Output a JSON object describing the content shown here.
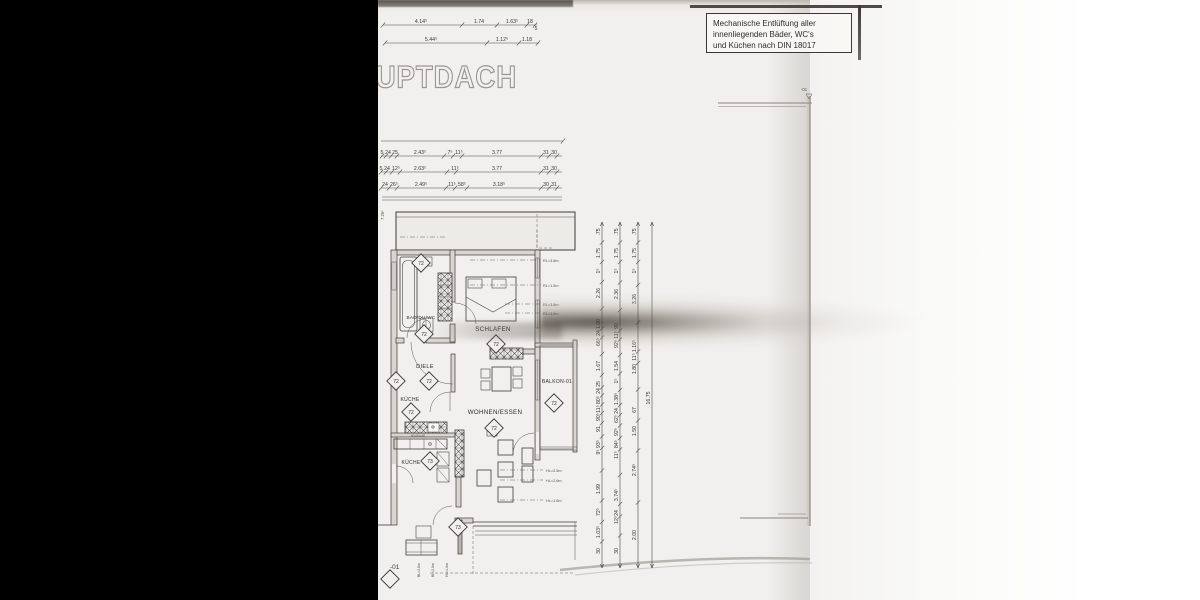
{
  "colors": {
    "paper": "#f1f0ee",
    "ink": "#3a3835",
    "black_bar": "#000000"
  },
  "title": {
    "text": "HAUPTDACH"
  },
  "note_box": {
    "line1": "Mechanische Entlüftung aller",
    "line2": "innenliegenden Bäder, WC's",
    "line3": "und Küchen nach DIN 18017"
  },
  "plan": {
    "rooms": {
      "bad": "BAD/DU/WC",
      "schlafen": "SCHLAFEN",
      "diele": "DIELE",
      "kueche1": "KÜCHE",
      "wohnen": "WOHNEN/ESSEN",
      "balkon": "BALKON-01",
      "kueche2": "KÜCHE"
    },
    "unit_primary": "72",
    "unit_secondary": "73",
    "level_label": "-01",
    "elevation_label": "-01",
    "left_edge_dim": "7.26⁵",
    "counter_dims": "60=60=60",
    "height_labels_upper": [
      "RL=3.8m",
      "RL=1.5m",
      "RL=3.8m",
      "RL=3.8m"
    ],
    "height_labels_lower": [
      "HL=2.5m",
      "HL=2.6m",
      "HL=1.6m"
    ],
    "height_labels_bottom": [
      "BL=2.8m",
      "BL=2.8m",
      "HL=1.6m"
    ]
  },
  "dims": {
    "horizontal_chains": [
      {
        "y": 25,
        "x1": 383,
        "x2": 537,
        "ticks": [
          383,
          462,
          497,
          527,
          535
        ],
        "labels": [
          {
            "t": "4.14⁵",
            "x": 421
          },
          {
            "t": "1.74",
            "x": 479
          },
          {
            "t": "1.63⁵",
            "x": 512
          },
          {
            "t": "18",
            "x": 530
          },
          {
            "t": "5",
            "x": 536,
            "dy": 7
          }
        ]
      },
      {
        "y": 43,
        "x1": 385,
        "x2": 539,
        "ticks": [
          385,
          487,
          519,
          538
        ],
        "labels": [
          {
            "t": "5.44⁵",
            "x": 431
          },
          {
            "t": "1.12⁵",
            "x": 502
          },
          {
            "t": "1.18",
            "x": 527
          }
        ]
      },
      {
        "y": 141,
        "x1": 381,
        "x2": 563,
        "ticks": [
          563
        ],
        "labels": []
      },
      {
        "y": 156,
        "x1": 381,
        "x2": 562,
        "ticks": [
          382,
          386,
          391,
          397,
          444,
          453,
          462,
          541,
          549,
          557
        ],
        "labels": [
          {
            "t": "5",
            "x": 382
          },
          {
            "t": "24",
            "x": 388
          },
          {
            "t": "25",
            "x": 395
          },
          {
            "t": "2.43⁵",
            "x": 420
          },
          {
            "t": "7⁵",
            "x": 450
          },
          {
            "t": "11⁵",
            "x": 459
          },
          {
            "t": "3.77",
            "x": 497
          },
          {
            "t": "31",
            "x": 546
          },
          {
            "t": "30",
            "x": 554
          }
        ]
      },
      {
        "y": 172,
        "x1": 381,
        "x2": 562,
        "ticks": [
          381,
          386,
          392,
          400,
          447,
          456,
          541,
          549,
          557
        ],
        "labels": [
          {
            "t": "5",
            "x": 381
          },
          {
            "t": "24",
            "x": 387
          },
          {
            "t": "12⁵",
            "x": 396
          },
          {
            "t": "2.63⁵",
            "x": 420
          },
          {
            "t": "11⁵",
            "x": 455
          },
          {
            "t": "3.77",
            "x": 497
          },
          {
            "t": "31",
            "x": 546
          },
          {
            "t": "30",
            "x": 554
          }
        ]
      },
      {
        "y": 188,
        "x1": 381,
        "x2": 562,
        "ticks": [
          381,
          389,
          397,
          446,
          455,
          467,
          541,
          549,
          557
        ],
        "labels": [
          {
            "t": "24",
            "x": 385
          },
          {
            "t": "26⁵",
            "x": 394
          },
          {
            "t": "2.49⁵",
            "x": 421
          },
          {
            "t": "11⁵",
            "x": 452
          },
          {
            "t": "58⁵",
            "x": 462
          },
          {
            "t": "3.18⁵",
            "x": 499
          },
          {
            "t": "30",
            "x": 546
          },
          {
            "t": "31",
            "x": 554
          }
        ]
      }
    ],
    "vertical_chains": [
      {
        "x": 602,
        "y1": 222,
        "y2": 568,
        "labels": [
          {
            "t": ".75",
            "y": 232
          },
          {
            "t": "1.75",
            "y": 253
          },
          {
            "t": "1⁵",
            "y": 271
          },
          {
            "t": "2.26",
            "y": 293
          },
          {
            "t": "1.00",
            "y": 324
          },
          {
            "t": "24",
            "y": 333
          },
          {
            "t": "66⁵",
            "y": 342
          },
          {
            "t": "1.67",
            "y": 366
          },
          {
            "t": "25",
            "y": 384
          },
          {
            "t": "24",
            "y": 391
          },
          {
            "t": "80⁵",
            "y": 400
          },
          {
            "t": "11⁵",
            "y": 409
          },
          {
            "t": "90⁵",
            "y": 417
          },
          {
            "t": "91",
            "y": 429
          },
          {
            "t": "93⁵",
            "y": 444
          },
          {
            "t": "9⁵",
            "y": 452
          },
          {
            "t": "1.99",
            "y": 489
          },
          {
            "t": "72⁵",
            "y": 512
          },
          {
            "t": "1.03⁵",
            "y": 532
          },
          {
            "t": "30",
            "y": 551
          }
        ]
      },
      {
        "x": 620,
        "y1": 222,
        "y2": 568,
        "labels": [
          {
            "t": ".75",
            "y": 232
          },
          {
            "t": "1.75",
            "y": 253
          },
          {
            "t": "1⁵",
            "y": 271
          },
          {
            "t": "2.36",
            "y": 294
          },
          {
            "t": "90",
            "y": 326
          },
          {
            "t": "11⁵",
            "y": 335
          },
          {
            "t": "92⁵",
            "y": 344
          },
          {
            "t": "1.54",
            "y": 366
          },
          {
            "t": "1⁵",
            "y": 381
          },
          {
            "t": "1.38⁵",
            "y": 399
          },
          {
            "t": "24",
            "y": 411
          },
          {
            "t": "62⁵",
            "y": 419
          },
          {
            "t": "92⁵",
            "y": 432
          },
          {
            "t": "84⁵",
            "y": 444
          },
          {
            "t": "11⁵",
            "y": 455
          },
          {
            "t": "3.74⁵",
            "y": 495
          },
          {
            "t": "24",
            "y": 513
          },
          {
            "t": "12⁵",
            "y": 520
          },
          {
            "t": "30",
            "y": 551
          }
        ]
      },
      {
        "x": 638,
        "y1": 222,
        "y2": 568,
        "labels": [
          {
            "t": ".75",
            "y": 232
          },
          {
            "t": "1.75",
            "y": 253
          },
          {
            "t": "1⁵",
            "y": 271
          },
          {
            "t": "3.26",
            "y": 299
          },
          {
            "t": "1.16⁵",
            "y": 346
          },
          {
            "t": "11⁵",
            "y": 357
          },
          {
            "t": "1.80",
            "y": 369
          },
          {
            "t": "67",
            "y": 410
          },
          {
            "t": "1.50",
            "y": 431
          },
          {
            "t": "2.74⁵",
            "y": 470
          },
          {
            "t": "2.00",
            "y": 535
          }
        ]
      },
      {
        "x": 652,
        "y1": 222,
        "y2": 568,
        "labels": [
          {
            "t": "16.75",
            "y": 398
          }
        ]
      }
    ]
  }
}
